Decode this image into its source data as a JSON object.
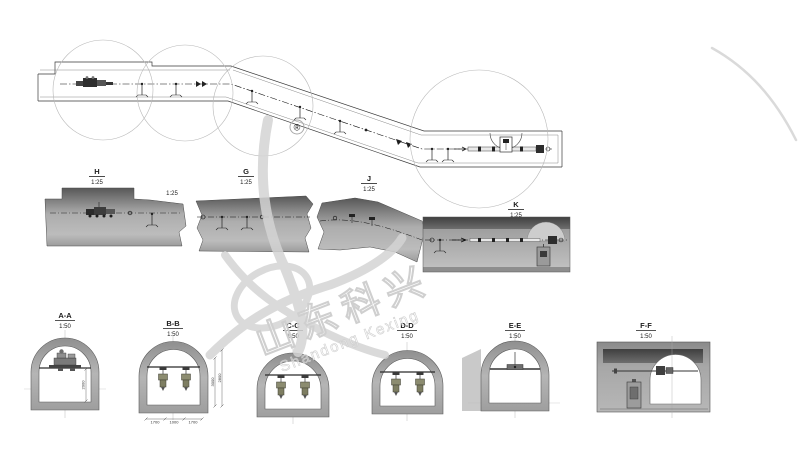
{
  "profiles": [
    {
      "label": "H",
      "scale": "1:25"
    },
    {
      "label": "G",
      "scale": "1:25"
    },
    {
      "label": "J",
      "scale": "1:25"
    },
    {
      "label": "K",
      "scale": "1:25"
    }
  ],
  "h_right_scale": "1:25",
  "sections": [
    {
      "label": "A-A",
      "scale": "1:50"
    },
    {
      "label": "B-B",
      "scale": "1:50"
    },
    {
      "label": "C-C",
      "scale": "1:50"
    },
    {
      "label": "D-D",
      "scale": "1:50"
    },
    {
      "label": "E-E",
      "scale": "1:50"
    },
    {
      "label": "F-F",
      "scale": "1:50"
    }
  ],
  "dimensions": {
    "aa_height": "2000",
    "bb_height_inner": "3000",
    "bb_height_outer": "2800",
    "bb_width_left": "1700",
    "bb_width_mid": "1000",
    "bb_width_right": "1700"
  },
  "watermark": {
    "cn": "山东科兴",
    "en": "Shandong Kexing",
    "registered": "®"
  },
  "colors": {
    "line": "#3a3a3a",
    "profile_dark": "#585858",
    "profile_light": "#bcbcbc",
    "ring_gray": "#a9a9a9",
    "watermark_gray": "#d4d4d4"
  }
}
